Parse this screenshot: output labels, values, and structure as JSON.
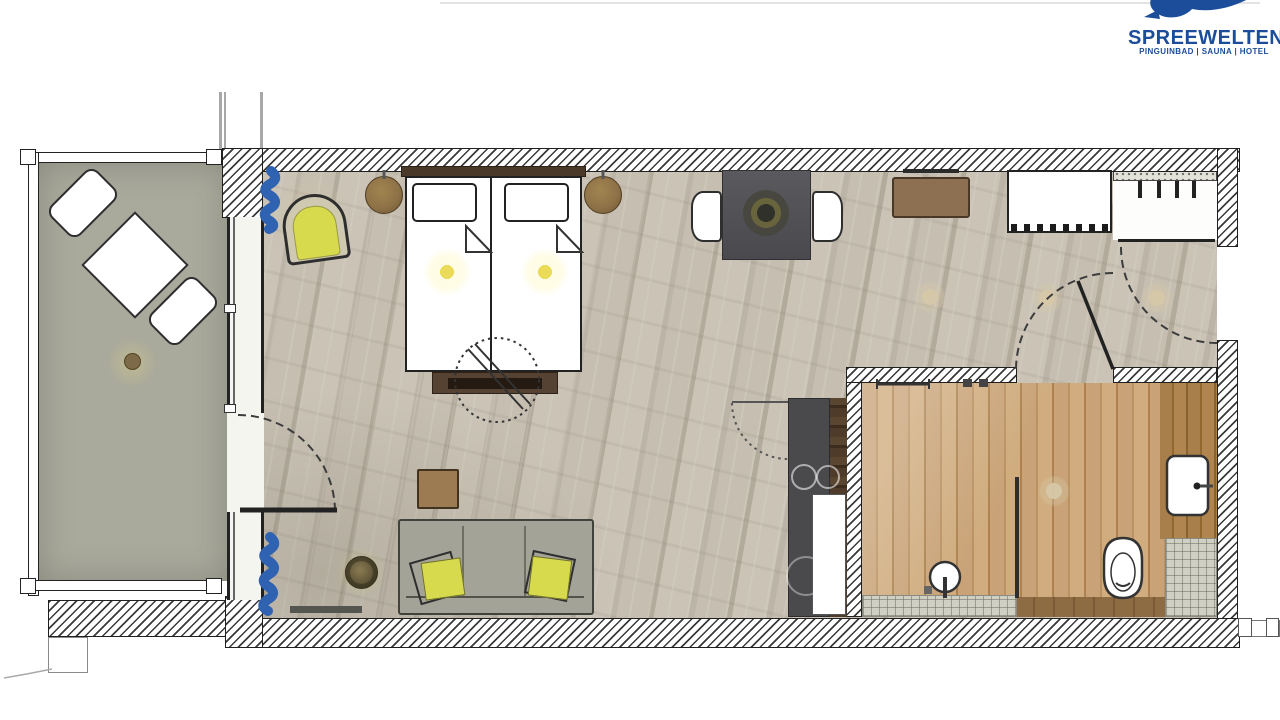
{
  "logo": {
    "brand": "SPREEWELTEN",
    "tagline": "PINGUINBAD | SAUNA | HOTEL"
  },
  "colors": {
    "logo_blue": "#1b4d9b",
    "curtain_blue": "#2f62b0",
    "accent_yellow": "#d8da4e",
    "wall_line": "#1f1f1f",
    "hatch_line": "#3a3a3a",
    "floor_main": "#c6bfb2",
    "floor_bath": "#c29e6f",
    "floor_balcony": "#a9a99c",
    "tile": "#cfcfc3",
    "counter_dark": "#4a4a4c",
    "wood_dark": "#4e3b2a",
    "furniture_brown": "#8d7051",
    "table_dark": "#55555a",
    "sofa_gray": "#a4a398",
    "light_glow": "#d9c9a4"
  }
}
